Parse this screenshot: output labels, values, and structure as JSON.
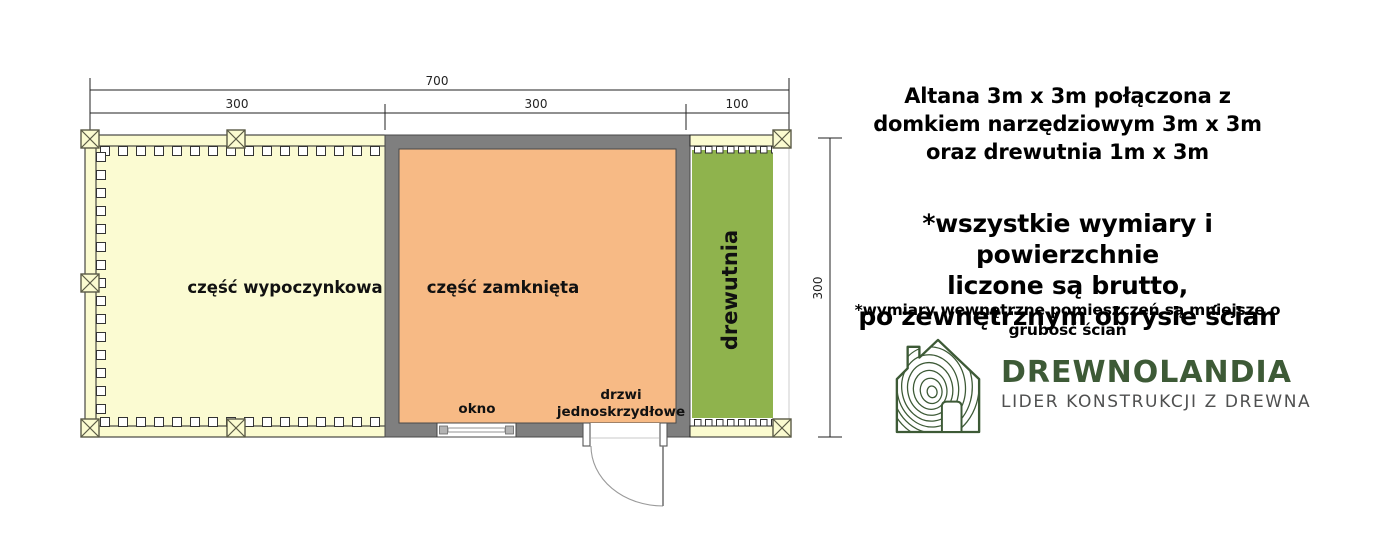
{
  "plan": {
    "dim_total": "700",
    "dim_segments": [
      "300",
      "300",
      "100"
    ],
    "dim_height": "300",
    "area_left": "część wypoczynkowa",
    "area_middle": "część zamknięta",
    "area_right": "drewutnia",
    "window_label": "okno",
    "door_label_line1": "drzwi",
    "door_label_line2": "jednoskrzydłowe",
    "colors": {
      "open_area_fill": "#FBFBD2",
      "railing_fill": "#FBFBD0",
      "closed_area_fill": "#F7BA85",
      "woodshed_fill": "#8FB34D",
      "wall_fill": "#7F7F7F"
    }
  },
  "info": {
    "title_lines": [
      "Altana 3m x 3m połączona z",
      "domkiem narzędziowym 3m x 3m",
      "oraz drewutnia 1m x 3m"
    ],
    "note_lines": [
      "*wszystkie wymiary i powierzchnie",
      "liczone są brutto,",
      "po zewnętrznym obrysie ścian"
    ],
    "note_small": "*wymiary wewnętrzne pomieszczeń są mniejsze o grubość ścian",
    "logo": {
      "name": "DREWNOLANDIA",
      "tagline": "LIDER KONSTRUKCJI Z DREWNA",
      "brand_color": "#3D5A36",
      "tagline_color": "#4F5050"
    }
  }
}
